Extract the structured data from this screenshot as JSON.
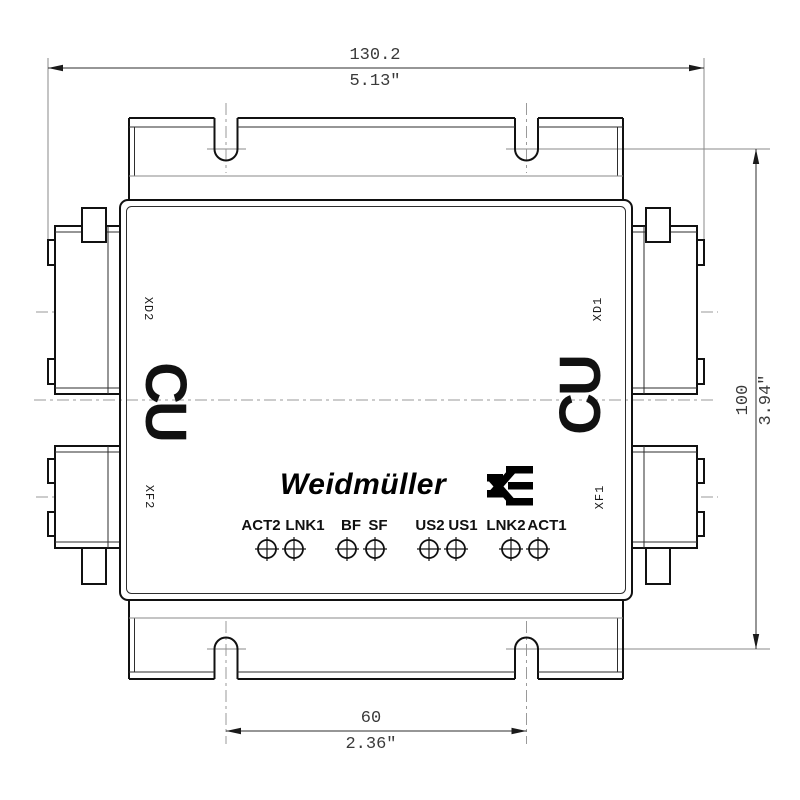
{
  "meta": {
    "type": "technical-dimension-drawing",
    "background": "#ffffff",
    "line_color": "#111111",
    "thin_line_color": "#2e2e2e",
    "gray_line_color": "#8a8a8a",
    "centerline_color": "#999999"
  },
  "brand": {
    "name": "Weidmüller",
    "mark": "weidmueller-w-mark"
  },
  "device": {
    "material_marking_left": "CU",
    "material_marking_right": "CU",
    "ports": {
      "xd2": "XD2",
      "xd1": "XD1",
      "xf2": "XF2",
      "xf1": "XF1"
    }
  },
  "leds": [
    "ACT2",
    "LNK1",
    "BF",
    "SF",
    "US2",
    "US1",
    "LNK2",
    "ACT1"
  ],
  "dimensions": {
    "width": {
      "mm": "130.2",
      "inch": "5.13\""
    },
    "height": {
      "mm": "100",
      "inch": "3.94\""
    },
    "slot_spacing": {
      "mm": "60",
      "inch": "2.36\""
    }
  }
}
